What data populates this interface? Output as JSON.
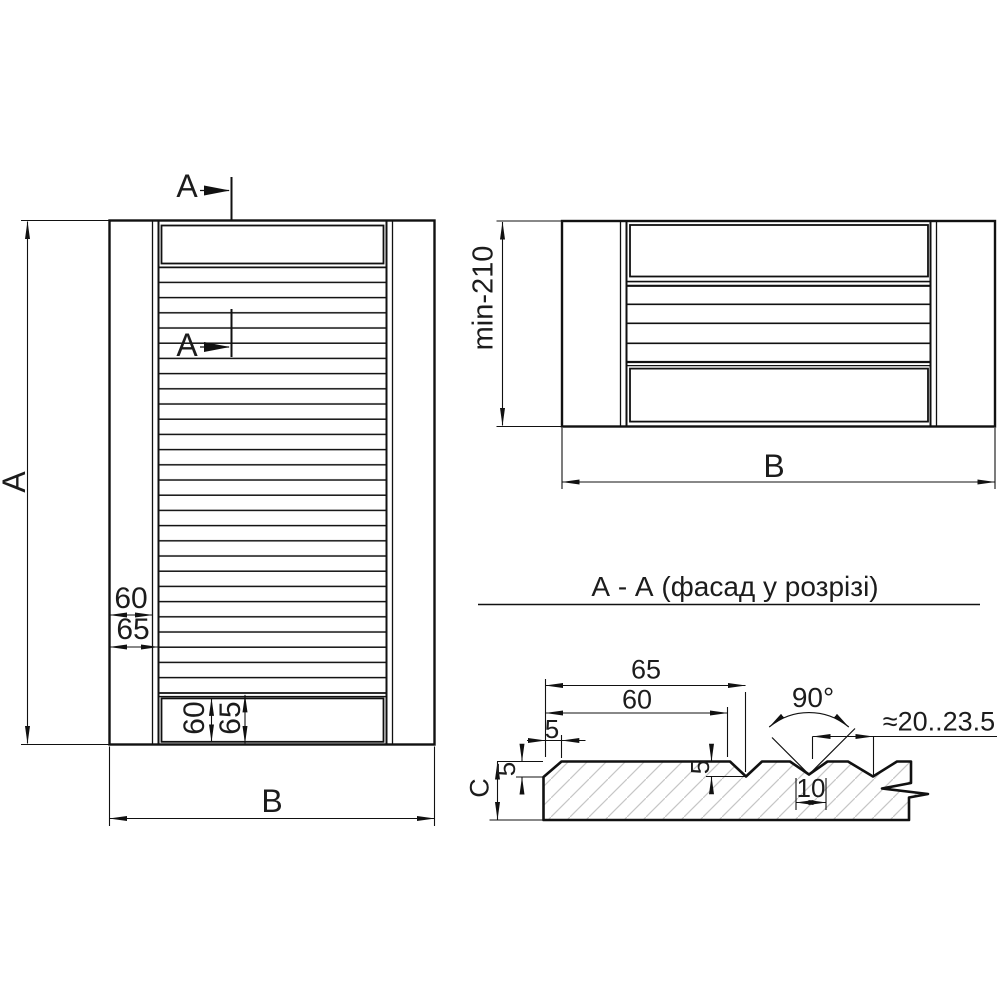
{
  "front_view": {
    "marker_top": "A",
    "marker_mid": "A",
    "dim_height": "A",
    "dim_width": "B",
    "dim_stile_face": "60",
    "dim_stile_full": "65",
    "dim_rail_face": "60",
    "dim_rail_full": "65"
  },
  "plan_view": {
    "dim_height": "min-210",
    "dim_width": "B"
  },
  "section_view": {
    "title": "А - А (фасад у розрізі)",
    "dim_slat_full": "65",
    "dim_slat_face": "60",
    "dim_chamfer_width": "5",
    "dim_chamfer_depth": "5",
    "dim_notch_depth": "5",
    "dim_groove_width": "10",
    "dim_groove_angle": "90°",
    "dim_slat_spacing": "≈20..23.5",
    "dim_thickness": "C"
  },
  "colors": {
    "line": "#111111",
    "hatch": "#c6c6c6",
    "background": "#ffffff"
  }
}
